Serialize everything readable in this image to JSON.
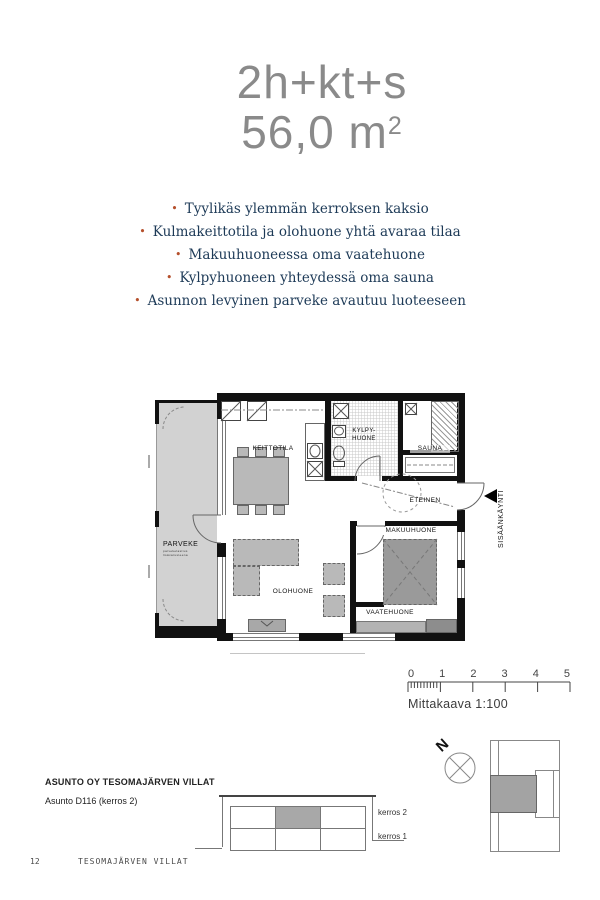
{
  "header": {
    "type_label": "2h+kt+s",
    "area": "56,0 m",
    "area_sup": "2"
  },
  "features": [
    "Tyylikäs ylemmän kerroksen kaksio",
    "Kulmakeittotila ja olohuone yhtä avaraa tilaa",
    "Makuuhuoneessa oma vaatehuone",
    "Kylpyhuoneen yhteydessä oma sauna",
    "Asunnon levyinen parveke avautuu luoteeseen"
  ],
  "floorplan": {
    "labels": {
      "parveke": "PARVEKE",
      "parveke_note1": "parvekelasitus",
      "parveke_note2": "lisävarusteena",
      "keittotila": "KEITTOTILA",
      "kylpyhuone_line1": "KYLPY-",
      "kylpyhuone_line2": "HUONE",
      "sauna": "SAUNA",
      "eteinen": "ETEINEN",
      "makuuhuone": "MAKUUHUONE",
      "vaatehuone": "VAATEHUONE",
      "olohuone": "OLOHUONE"
    },
    "entrance": "SISÄÄNKÄYNTI"
  },
  "scalebar": {
    "ticks": [
      "0",
      "1",
      "2",
      "3",
      "4",
      "5"
    ],
    "caption": "Mittakaava 1:100"
  },
  "compass": {
    "north": "N"
  },
  "project": {
    "name": "ASUNTO OY TESOMAJÄRVEN VILLAT",
    "unit": "Asunto D116 (kerros 2)"
  },
  "elevation": {
    "floor_labels": [
      "kerros 2",
      "kerros 1"
    ]
  },
  "footer": {
    "page": "12",
    "text": "TESOMAJÄRVEN VILLAT"
  },
  "colors": {
    "title_gray": "#8a8a8a",
    "feature_text": "#1d3a57",
    "bullet": "#b5502c",
    "wall": "#111111",
    "balcony_fill": "#d2d2d2",
    "furniture": "#b9b9b9",
    "bed": "#9a9a9a",
    "elevation_shade": "#a8a8a8"
  }
}
